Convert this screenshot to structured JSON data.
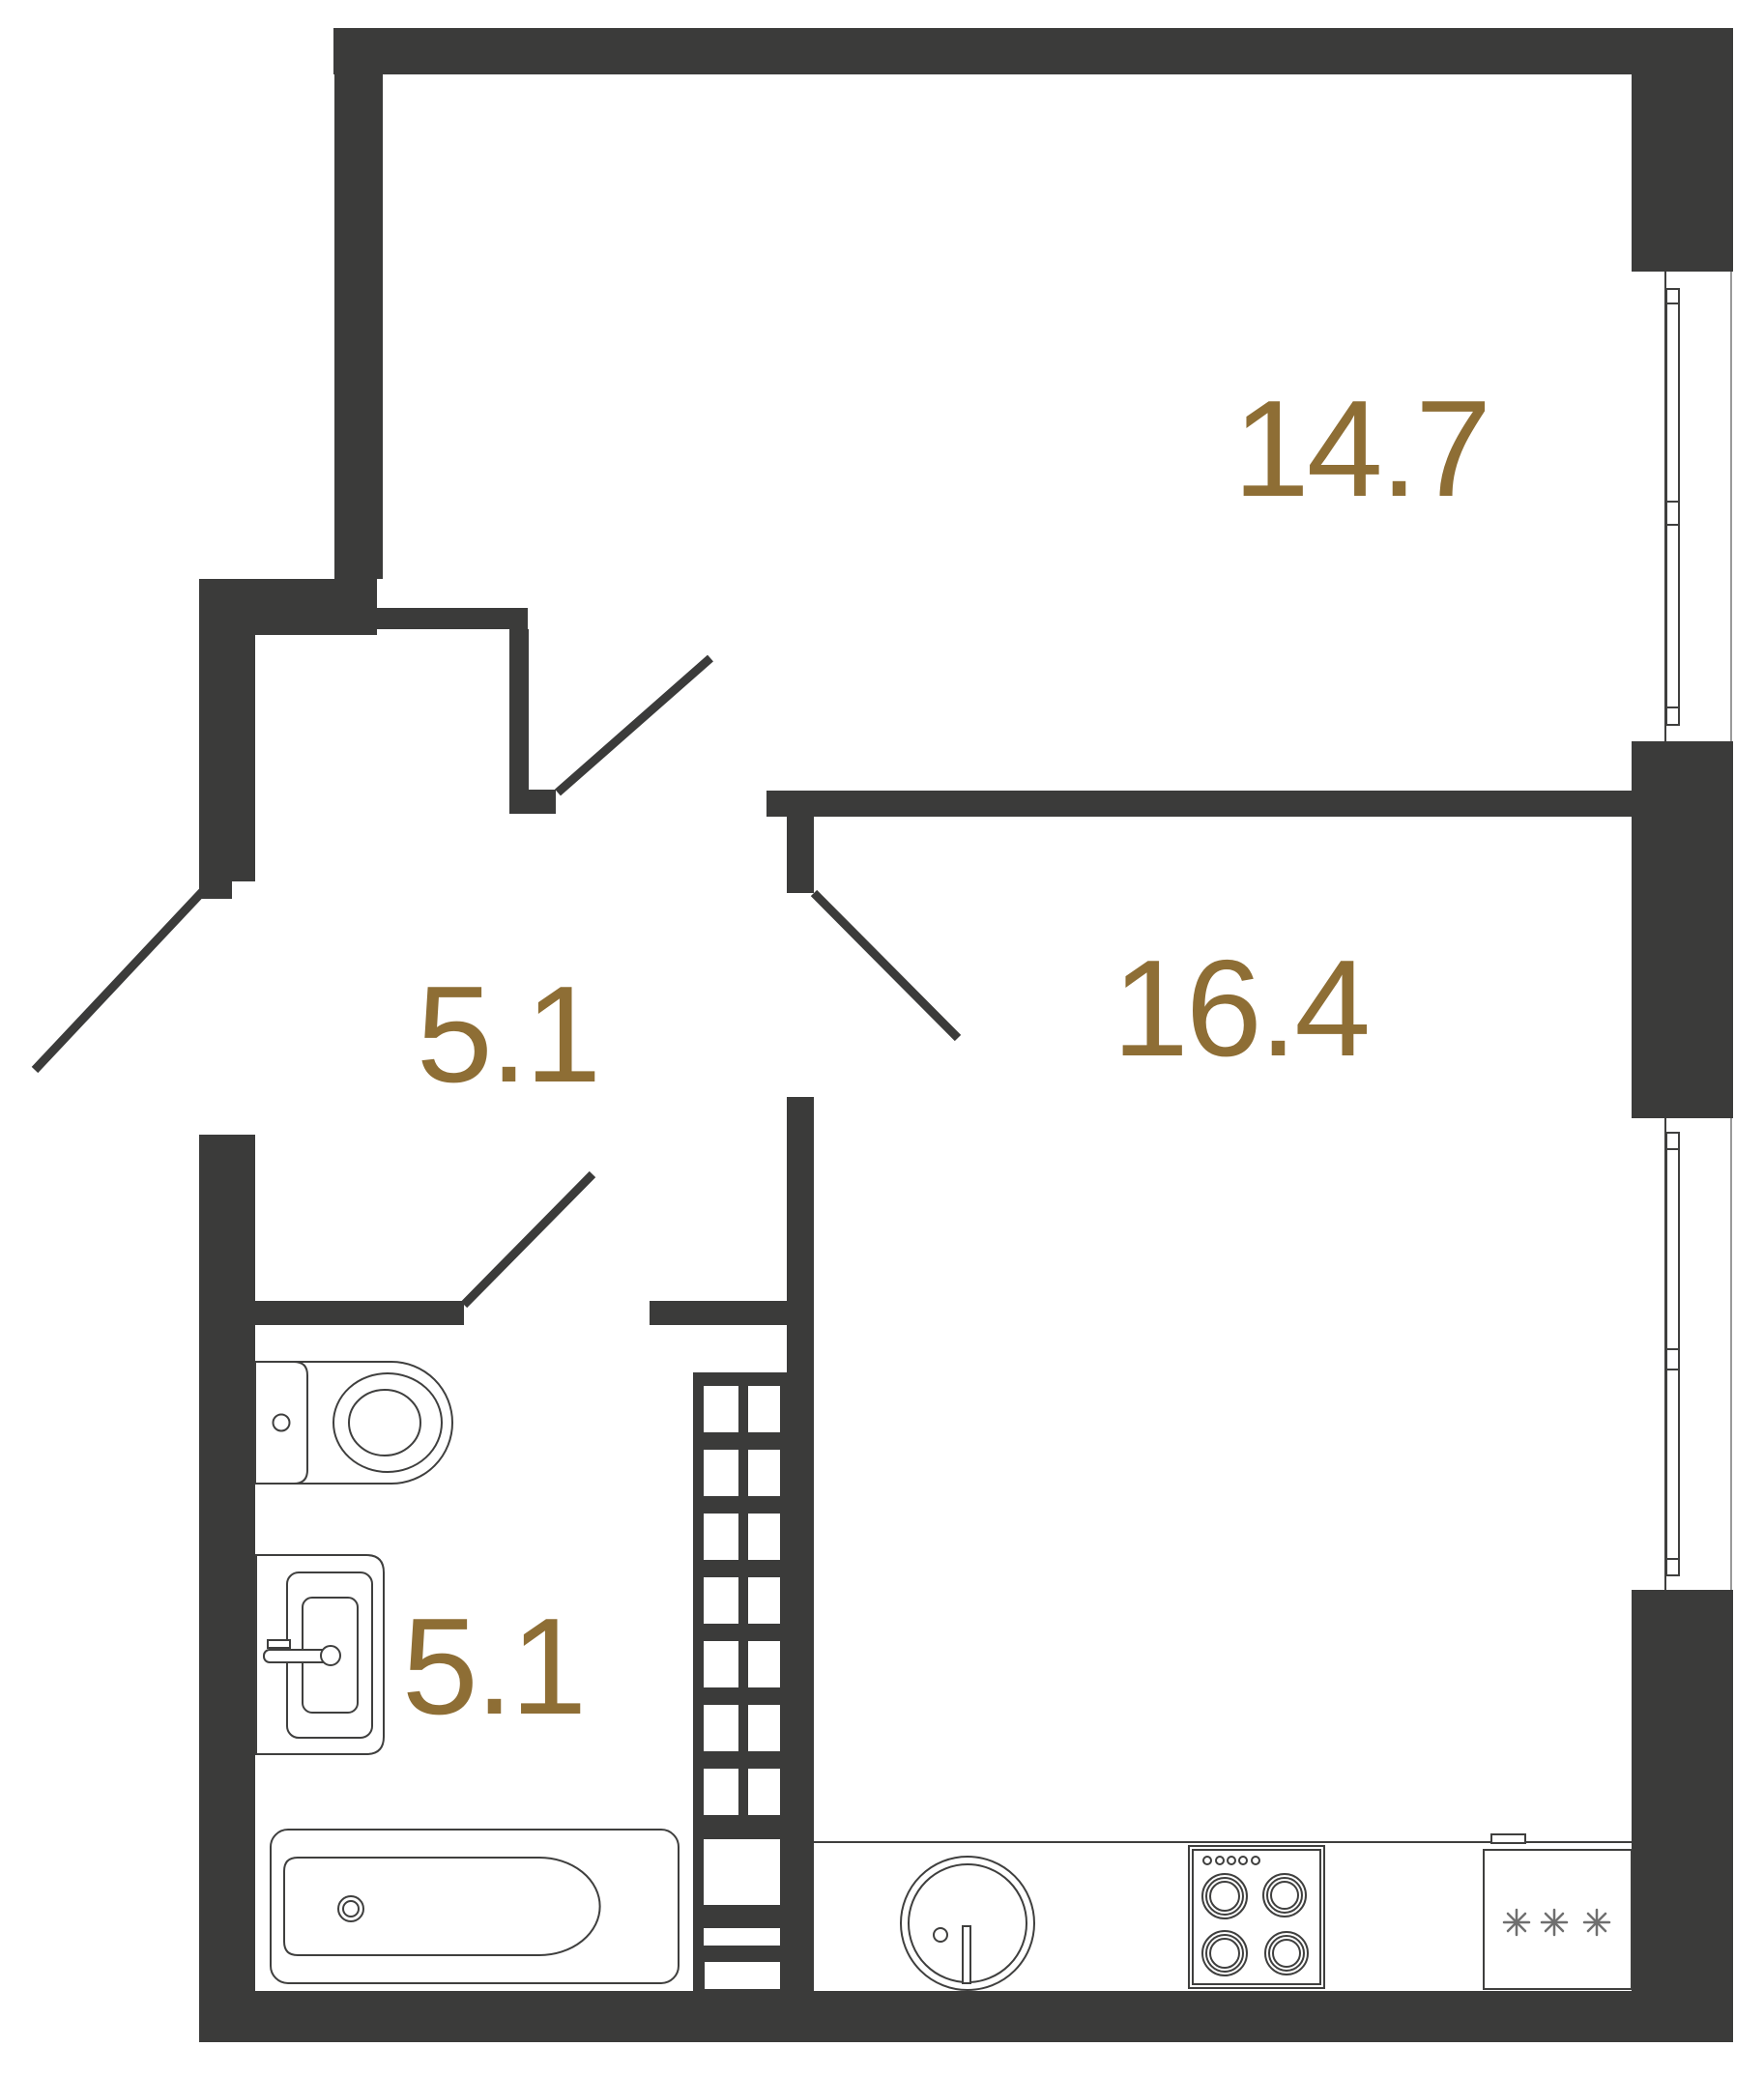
{
  "plan": {
    "type": "apartment-floor-plan",
    "rooms": [
      {
        "name": "living-room",
        "area": "14.7"
      },
      {
        "name": "kitchen-living",
        "area": "16.4"
      },
      {
        "name": "hallway",
        "area": "5.1"
      },
      {
        "name": "bathroom",
        "area": "5.1"
      }
    ],
    "fixtures": [
      "toilet",
      "washbasin",
      "bathtub",
      "ventilation-shaft",
      "kitchen-sink",
      "cooktop",
      "refrigerator"
    ],
    "doors": 4,
    "windows": 2,
    "colors": {
      "wall": "#3b3b3a",
      "accent": "#8e6e35",
      "line": "#3f3f3e",
      "background": "#ffffff",
      "muted": "#9a9a9a"
    }
  }
}
